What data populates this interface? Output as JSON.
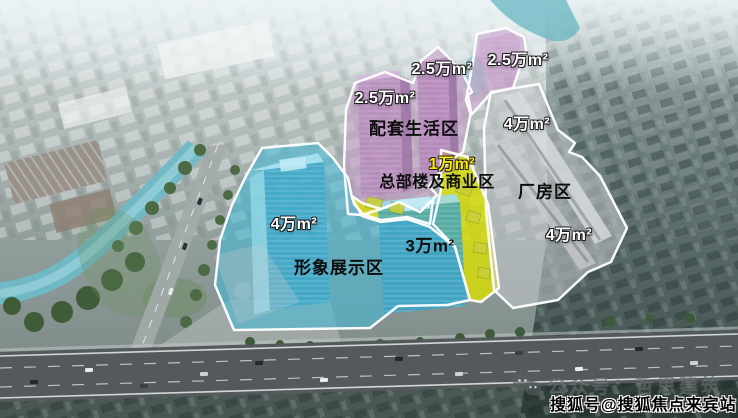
{
  "zones": {
    "living": {
      "name": "配套生活区",
      "areas": [
        "2.5万m²",
        "2.5万m²",
        "2.5万m²"
      ],
      "color": "#c89fcb"
    },
    "hq_commercial": {
      "name": "总部楼及商业区",
      "areas": [
        "1万m²"
      ],
      "color": "#d9df00"
    },
    "image_display": {
      "name": "形象展示区",
      "areas": [
        "4万m²",
        "3万m²"
      ],
      "color": "#45b9d6"
    },
    "factory": {
      "name": "厂房区",
      "areas": [
        "4万m²",
        "4万m²"
      ],
      "color": "#c6c9cc"
    }
  },
  "watermarks": {
    "wechat_label": "公众号：哲思建筑",
    "sohu_label": "搜狐号@搜狐焦点来宾站"
  }
}
